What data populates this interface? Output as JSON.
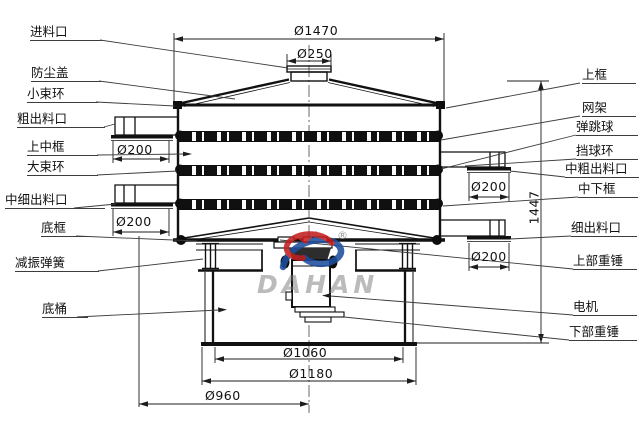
{
  "drawing": {
    "subject": "旋振筛结构剖面图",
    "watermark_brand": "DAHAN",
    "watermark_registered": "®"
  },
  "labels_left": [
    {
      "text": "进料口"
    },
    {
      "text": "防尘盖"
    },
    {
      "text": "小束环"
    },
    {
      "text": "粗出料口"
    },
    {
      "text": "上中框"
    },
    {
      "text": "大束环"
    },
    {
      "text": "中细出料口"
    },
    {
      "text": "底框"
    },
    {
      "text": "减振弹簧"
    },
    {
      "text": "底桶"
    }
  ],
  "labels_right": [
    {
      "text": "上框"
    },
    {
      "text": "网架"
    },
    {
      "text": "弹跳球"
    },
    {
      "text": "挡球环"
    },
    {
      "text": "中粗出料口"
    },
    {
      "text": "中下框"
    },
    {
      "text": "细出料口"
    },
    {
      "text": "上部重锤"
    },
    {
      "text": "电机"
    },
    {
      "text": "下部重锤"
    }
  ],
  "dimensions": {
    "top_diameter": "Ø1470",
    "inlet_diameter": "Ø250",
    "total_height": "1447",
    "outlet_left_upper": "Ø200",
    "outlet_left_lower": "Ø200",
    "outlet_right_upper": "Ø200",
    "outlet_right_lower": "Ø200",
    "base_inner_diameter": "Ø1060",
    "base_outer_diameter": "Ø1180",
    "spring_circle_diameter": "Ø960"
  }
}
